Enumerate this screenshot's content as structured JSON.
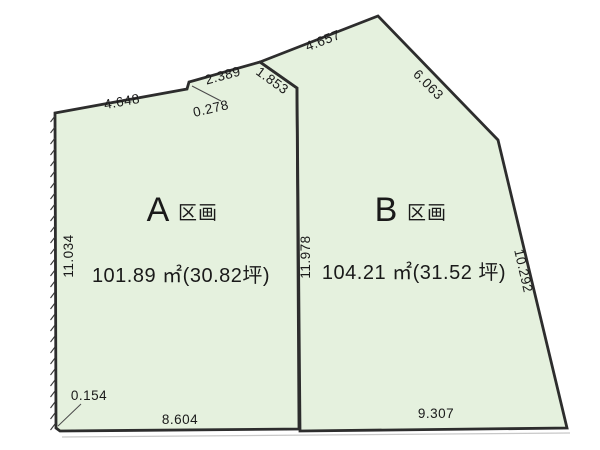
{
  "figure": {
    "title": "land-subdivision-diagram",
    "background": "#ffffff",
    "parcel_fill": "#e5f1de",
    "line_color": "#2d2d2d",
    "text_color": "#1a1a1a"
  },
  "parcel_a": {
    "letter": "A",
    "suffix": "区画",
    "area": "101.89 ㎡(30.82坪)"
  },
  "parcel_b": {
    "letter": "B",
    "suffix": "区画",
    "area": "104.21 ㎡(31.52 坪)"
  },
  "dims": {
    "a_top": "4.648",
    "a_step": "0.278",
    "top_mid": "2.389",
    "divider_top": "1.853",
    "b_top": "4.657",
    "b_northeast": "6.063",
    "a_west": "11.034",
    "divider": "11.978",
    "b_east": "10.292",
    "a_southwest_corner": "0.154",
    "a_south": "8.604",
    "b_south": "9.307"
  }
}
